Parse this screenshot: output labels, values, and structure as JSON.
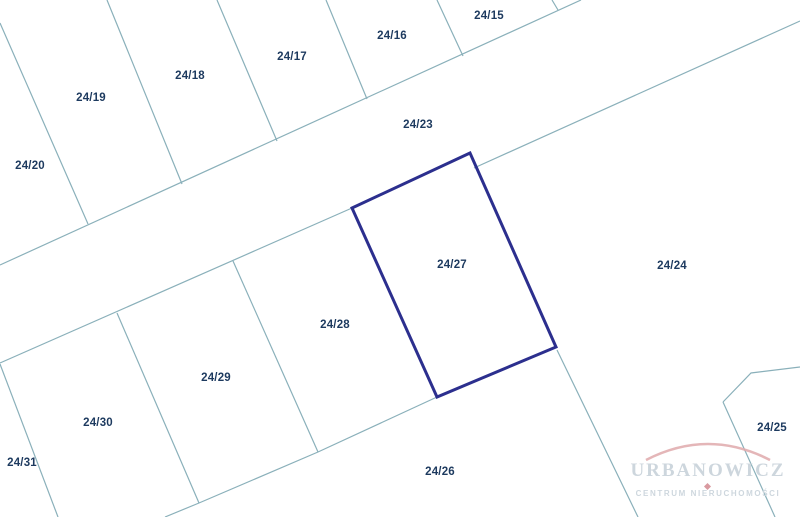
{
  "map": {
    "width": 800,
    "height": 517,
    "background_color": "#ffffff",
    "boundary_color": "#8ab0ba",
    "highlight_color": "#2c2f8e",
    "label_color": "#1d3a5f",
    "boundary_lines": [
      {
        "name": "road-upper-edge",
        "points": [
          [
            0,
            265
          ],
          [
            581,
            0
          ]
        ]
      },
      {
        "name": "road-lower-edge-west",
        "points": [
          [
            0,
            363
          ],
          [
            352,
            208
          ]
        ]
      },
      {
        "name": "road-lower-edge-east",
        "points": [
          [
            474,
            168
          ],
          [
            800,
            21
          ]
        ]
      },
      {
        "name": "divider-2420-2419",
        "points": [
          [
            0,
            23
          ],
          [
            88,
            224
          ]
        ]
      },
      {
        "name": "divider-2419-2418",
        "points": [
          [
            107,
            0
          ],
          [
            182,
            184
          ]
        ]
      },
      {
        "name": "divider-2418-2417",
        "points": [
          [
            217,
            0
          ],
          [
            277,
            141
          ]
        ]
      },
      {
        "name": "divider-2417-2416",
        "points": [
          [
            326,
            0
          ],
          [
            367,
            99
          ]
        ]
      },
      {
        "name": "divider-2416-2415",
        "points": [
          [
            437,
            0
          ],
          [
            463,
            56
          ]
        ]
      },
      {
        "name": "divider-2415-east",
        "points": [
          [
            552,
            0
          ],
          [
            558,
            10
          ]
        ]
      },
      {
        "name": "divider-2431-2430",
        "points": [
          [
            0,
            364
          ],
          [
            58,
            517
          ]
        ]
      },
      {
        "name": "divider-2430-2429",
        "points": [
          [
            117,
            313
          ],
          [
            199,
            503
          ]
        ]
      },
      {
        "name": "divider-2429-2428",
        "points": [
          [
            233,
            261
          ],
          [
            318,
            452
          ]
        ]
      },
      {
        "name": "south-block-boundary",
        "points": [
          [
            165,
            517
          ],
          [
            199,
            503
          ],
          [
            318,
            452
          ],
          [
            437,
            397
          ]
        ]
      },
      {
        "name": "divider-2426-2425",
        "points": [
          [
            557,
            350
          ],
          [
            638,
            517
          ]
        ]
      },
      {
        "name": "divider-2425-west",
        "points": [
          [
            723,
            402
          ],
          [
            775,
            517
          ]
        ]
      },
      {
        "name": "parcel-2425-north-edge",
        "points": [
          [
            723,
            402
          ],
          [
            751,
            373
          ],
          [
            800,
            367
          ]
        ]
      }
    ],
    "highlighted_parcel": {
      "label": "24/27",
      "points": [
        [
          470,
          153
        ],
        [
          352,
          208
        ],
        [
          437,
          397
        ],
        [
          556,
          347
        ]
      ]
    },
    "parcel_labels": [
      {
        "label": "24/15",
        "x": 489,
        "y": 16
      },
      {
        "label": "24/16",
        "x": 392,
        "y": 36
      },
      {
        "label": "24/17",
        "x": 292,
        "y": 57
      },
      {
        "label": "24/18",
        "x": 190,
        "y": 76
      },
      {
        "label": "24/19",
        "x": 91,
        "y": 98
      },
      {
        "label": "24/20",
        "x": 30,
        "y": 166
      },
      {
        "label": "24/23",
        "x": 418,
        "y": 125
      },
      {
        "label": "24/24",
        "x": 672,
        "y": 266
      },
      {
        "label": "24/27",
        "x": 452,
        "y": 265
      },
      {
        "label": "24/28",
        "x": 335,
        "y": 325
      },
      {
        "label": "24/29",
        "x": 216,
        "y": 378
      },
      {
        "label": "24/30",
        "x": 98,
        "y": 423
      },
      {
        "label": "24/31",
        "x": 22,
        "y": 463
      },
      {
        "label": "24/26",
        "x": 440,
        "y": 472
      },
      {
        "label": "24/25",
        "x": 772,
        "y": 428
      }
    ]
  },
  "watermark": {
    "title": "URBANOWICZ",
    "subtitle": "CENTRUM NIERUCHOMOŚCI",
    "title_color": "#cdd6dd",
    "accent_color": "#d99aa0"
  }
}
